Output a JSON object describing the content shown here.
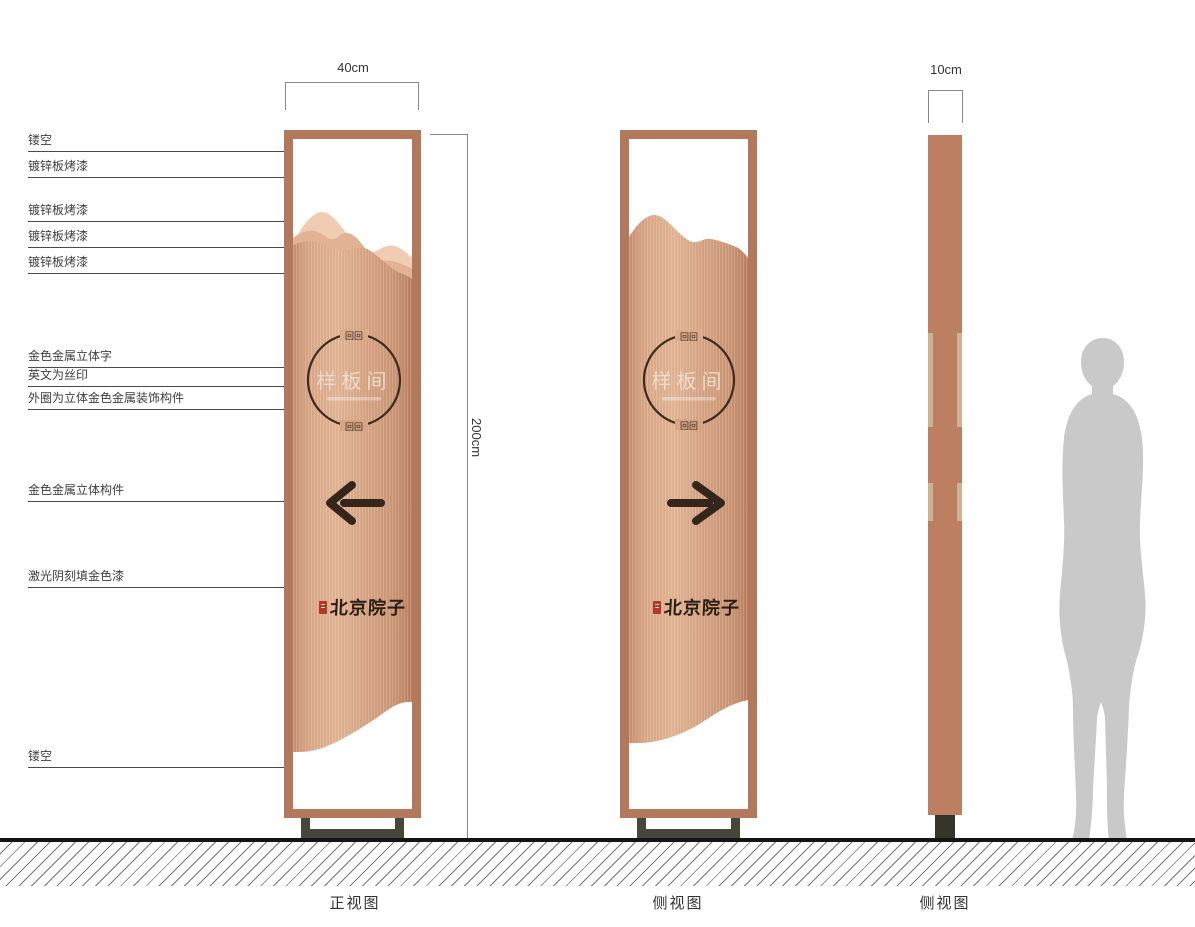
{
  "dimensions": {
    "width": "40cm",
    "height": "200cm",
    "thickness": "10cm"
  },
  "annotations": [
    "镂空",
    "镀锌板烤漆",
    "镀锌板烤漆",
    "镀锌板烤漆",
    "镀锌板烤漆",
    "金色金属立体字",
    "英文为丝印",
    "外圈为立体金色金属装饰构件",
    "金色金属立体构件",
    "激光阴刻填金色漆",
    "镂空"
  ],
  "sign": {
    "plaque_text": "样板间",
    "fret_ornament": "回回",
    "brand_text": "北京院子"
  },
  "views": {
    "front_label": "正视图",
    "back_label": "侧视图",
    "side_label": "侧视图"
  },
  "colors": {
    "frame": "#b3795c",
    "panel_copper": "#d9a787",
    "mountain_light": "#f0cdb2",
    "mountain_mid": "#e2b294",
    "ink": "#35261c",
    "seal_red": "#b5372a",
    "pedestal": "#46463a",
    "silhouette": "#c9c9c9",
    "plaque_text_color": "#ecdcca"
  }
}
